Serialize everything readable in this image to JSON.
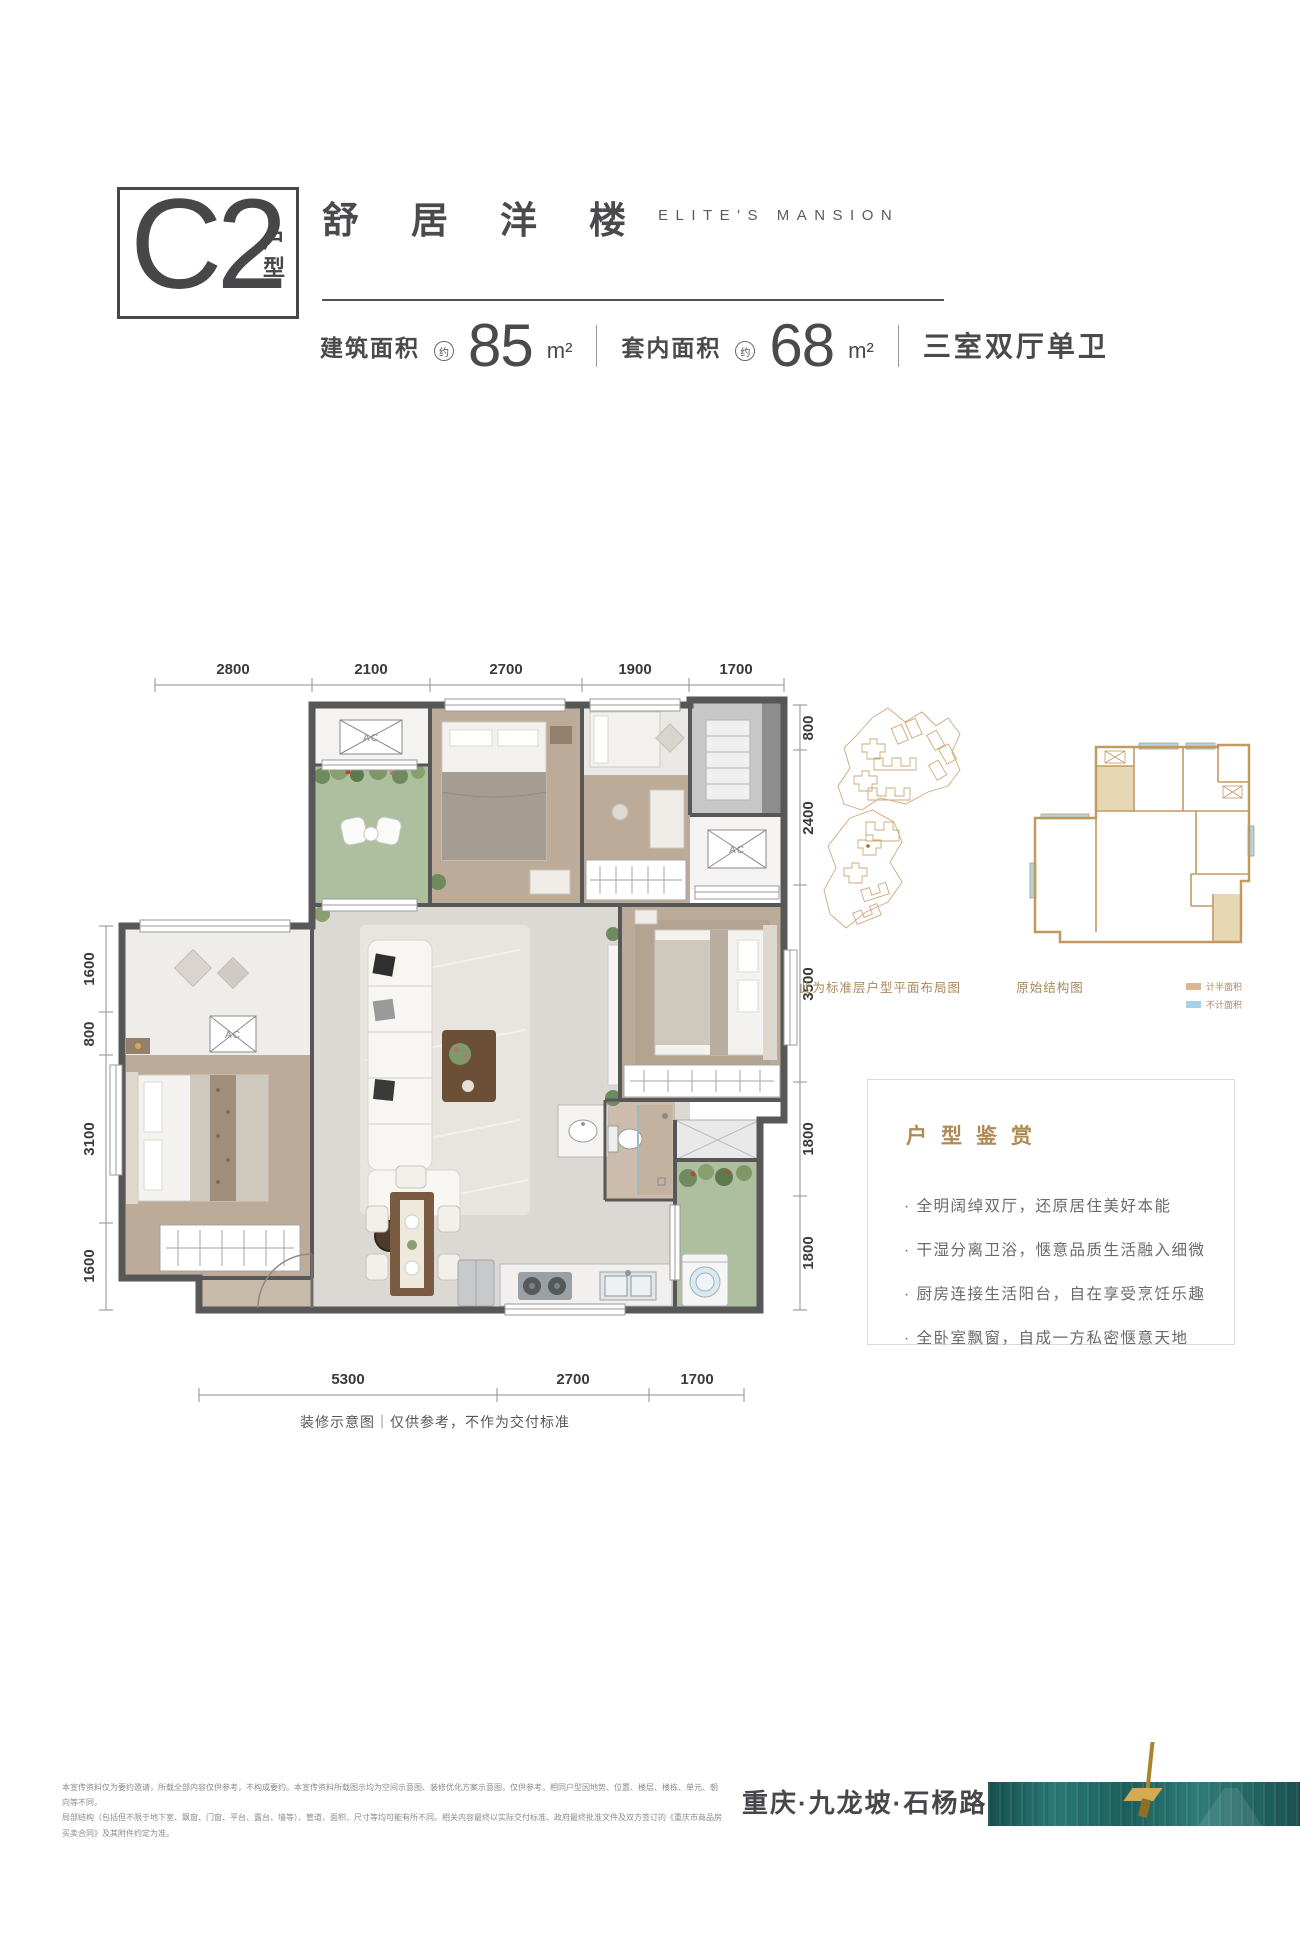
{
  "header": {
    "unit_code": "C2",
    "unit_suffix": "户型",
    "title_cn": "舒居洋楼",
    "title_en": "ELITE'S MANSION",
    "stats": [
      {
        "label": "建筑面积",
        "approx": "约",
        "value": "85",
        "unit": "m²"
      },
      {
        "label": "套内面积",
        "approx": "约",
        "value": "68",
        "unit": "m²"
      }
    ],
    "layout_desc": "三室双厅单卫"
  },
  "plan": {
    "ac_label": "AC",
    "dims_top": [
      "2800",
      "2100",
      "2700",
      "1900",
      "1700"
    ],
    "dims_left": [
      "1600",
      "800",
      "3100",
      "1600"
    ],
    "dims_right": [
      "800",
      "2400",
      "3500",
      "1800",
      "1800"
    ],
    "dims_bottom": [
      "5300",
      "2700",
      "1700"
    ],
    "caption": "装修示意图｜仅供参考，不作为交付标准"
  },
  "mini_diagrams": {
    "site_caption": "此为标准层户型平面布局图",
    "structure_caption": "原始结构图",
    "legend": [
      {
        "label": "计半面积",
        "color": "#d9b98c"
      },
      {
        "label": "不计面积",
        "color": "#a8cfe3"
      }
    ]
  },
  "highlights": {
    "title": "户型鉴赏",
    "items": [
      "· 全明阔绰双厅，还原居住美好本能",
      "· 干湿分离卫浴，惬意品质生活融入细微",
      "· 厨房连接生活阳台，自在享受烹饪乐趣",
      "· 全卧室飘窗，自成一方私密惬意天地"
    ]
  },
  "footer": {
    "disclaimer_line1": "本宣传资料仅为要约邀请，所载全部内容仅供参考，不构成要约。本宣传资料所载图示均为空间示意图、装修优化方案示意图，仅供参考。相同户型因地势、位置、楼层、楼栋、单元、朝向等不同，",
    "disclaimer_line2": "局部结构（包括但不限于地下室、飘窗、门窗、平台、露台、墙等）、管道、面积、尺寸等均可能有所不同。相关内容最终以实际交付标准、政府最终批准文件及双方签订的《重庆市商品房买卖合同》及其附件约定为准。",
    "location": "重庆·九龙坡·石杨路"
  },
  "colors": {
    "accent_tan": "#b08a55",
    "wall_gray": "#575757",
    "balcony_green": "#aebfa0",
    "wood_floor": "#bcab99",
    "living_floor": "#dcd9d4",
    "teal_band": "#1f605d",
    "gold_ribbon": "#a9852e",
    "legend_half_area": "#d9b98c",
    "legend_no_area": "#a8cfe3"
  }
}
